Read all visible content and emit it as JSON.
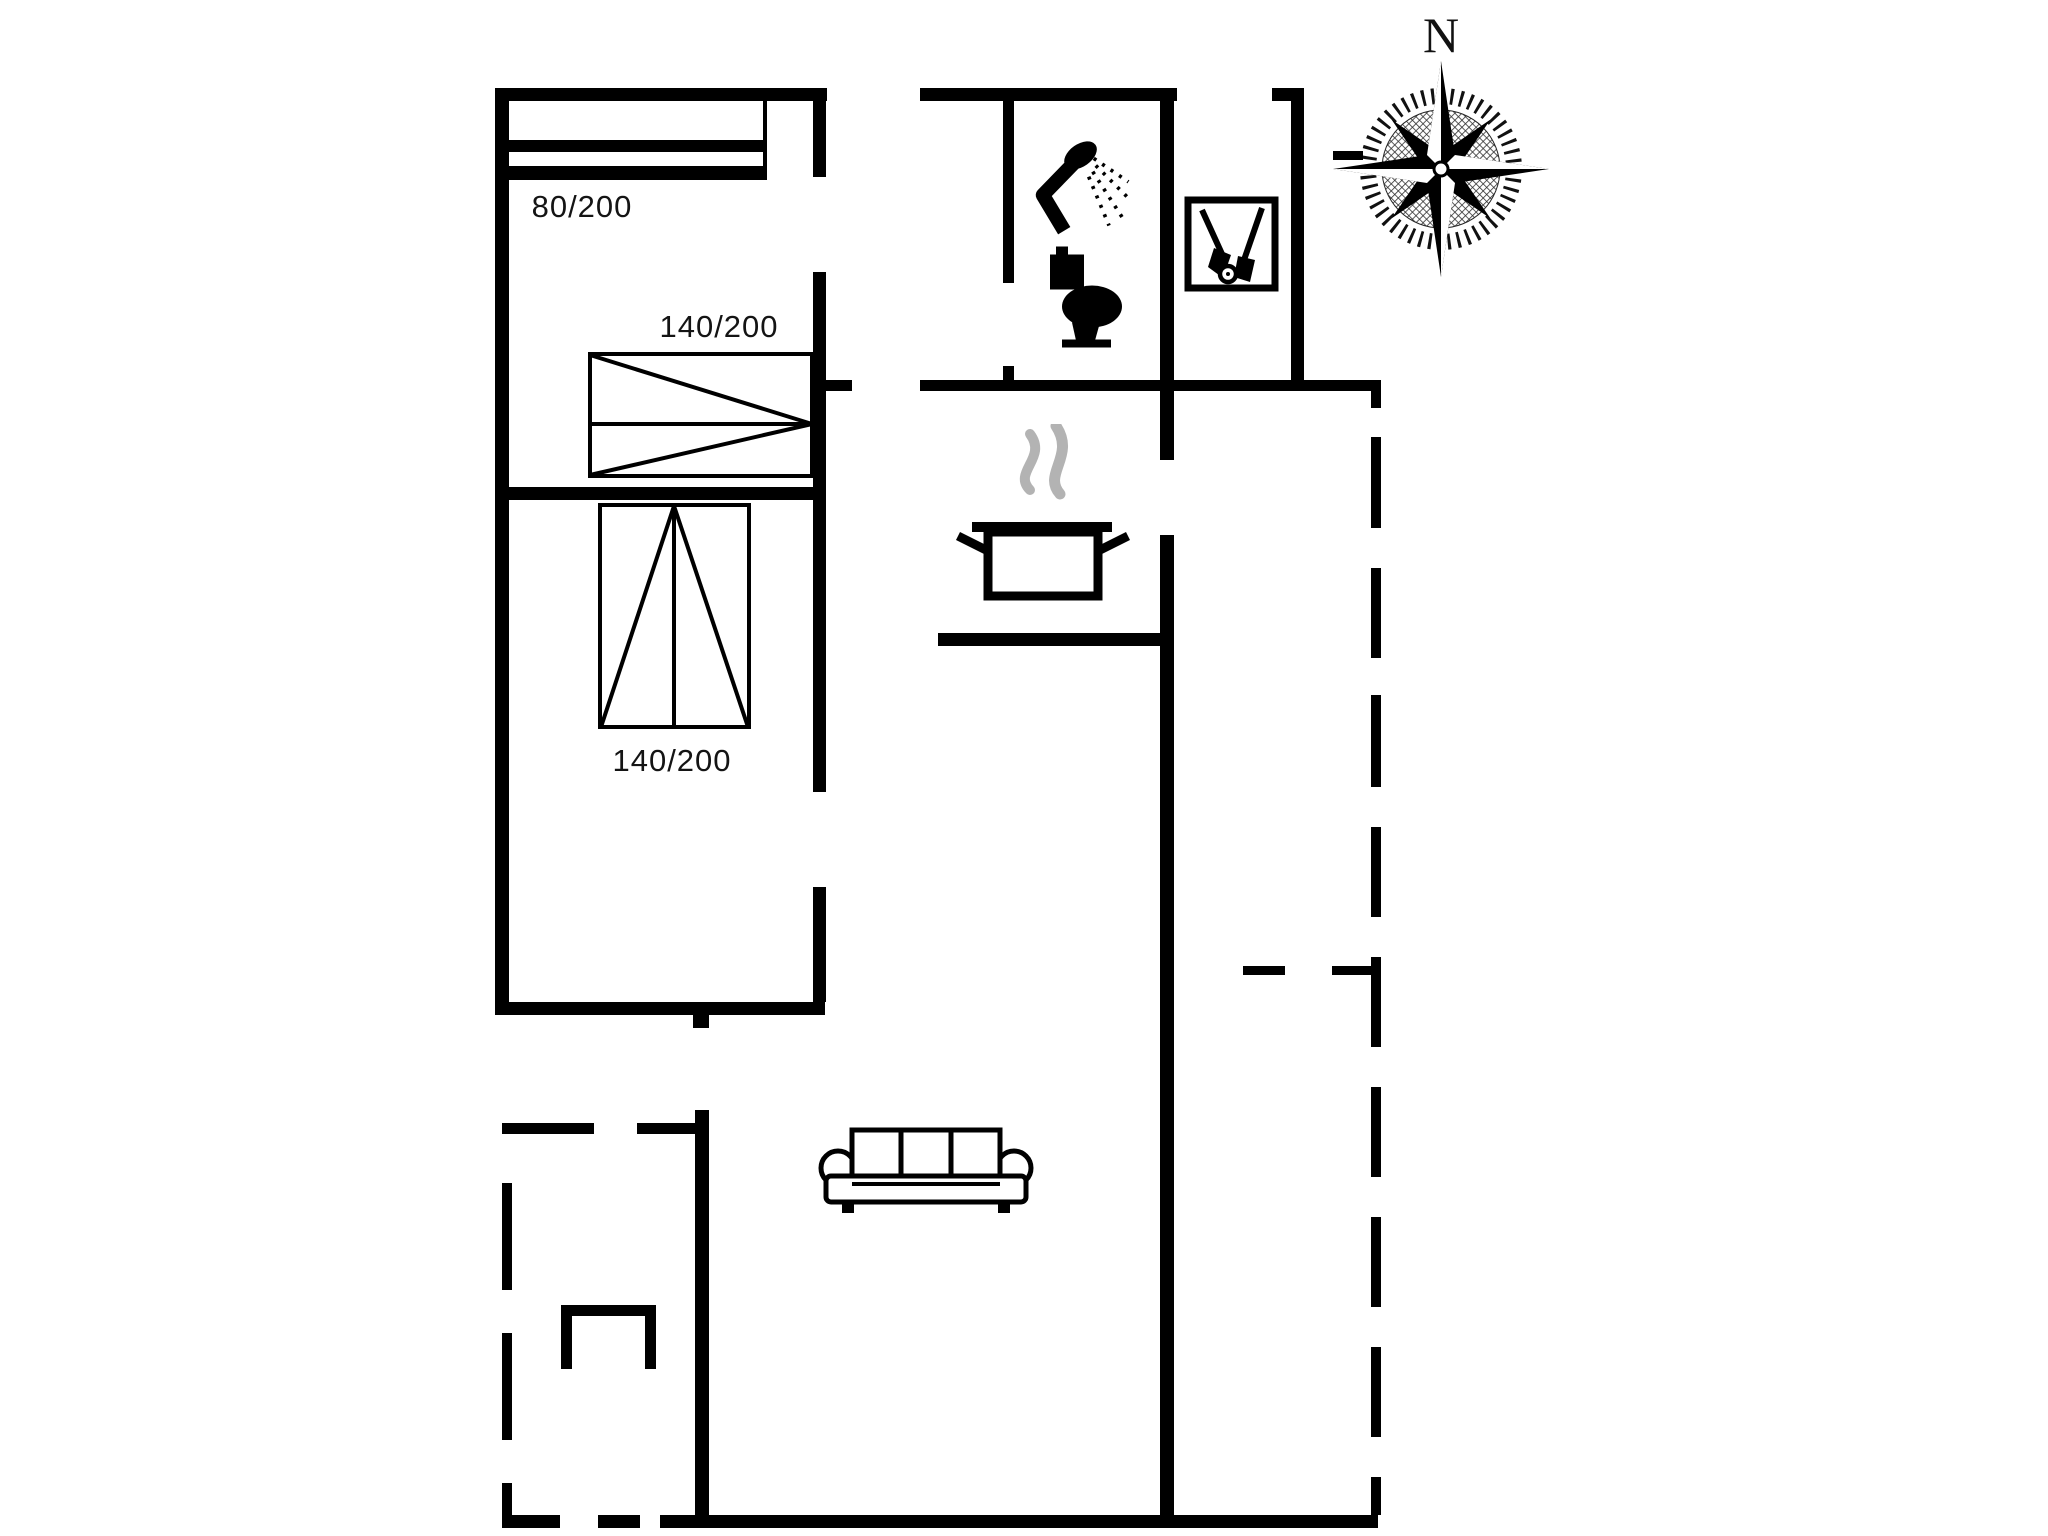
{
  "title": "Holiday home floor plan",
  "compass": {
    "north_label": "N"
  },
  "rooms": {
    "bedroom_single_bed_label": "80/200",
    "bedroom_double_bed_label": "140/200",
    "bedroom2_double_bed_label": "140/200"
  },
  "colors": {
    "wall": "#000000",
    "bg": "#ffffff",
    "steam": "#b3b3b3",
    "text": "#141414"
  },
  "icons": [
    "shower-icon",
    "toilet-icon",
    "cleaning-tools-icon",
    "cooking-pot-icon",
    "steam-icon",
    "sofa-icon",
    "grill-icon",
    "compass-rose-icon",
    "single-bed-symbol",
    "double-bed-symbol-horizontal",
    "double-bed-symbol-vertical"
  ],
  "plan": {
    "walls": [
      [
        495,
        88,
        332,
        13
      ],
      [
        495,
        88,
        14,
        927
      ],
      [
        495,
        1002,
        330,
        13
      ],
      [
        503,
        487,
        312,
        13
      ],
      [
        813,
        101,
        13,
        76
      ],
      [
        813,
        272,
        13,
        520
      ],
      [
        813,
        887,
        13,
        115
      ],
      [
        825,
        380,
        27,
        11
      ],
      [
        920,
        380,
        458,
        11
      ],
      [
        920,
        88,
        257,
        13
      ],
      [
        1003,
        101,
        11,
        182
      ],
      [
        1003,
        366,
        11,
        14
      ],
      [
        1160,
        101,
        14,
        359
      ],
      [
        1160,
        535,
        14,
        993
      ],
      [
        1272,
        88,
        32,
        13
      ],
      [
        1291,
        88,
        13,
        292
      ],
      [
        938,
        633,
        236,
        13
      ],
      [
        695,
        1110,
        14,
        418
      ],
      [
        693,
        1002,
        16,
        26
      ],
      [
        660,
        1515,
        718,
        13
      ],
      [
        1371,
        380,
        10,
        28
      ],
      [
        1333,
        151,
        30,
        9
      ],
      [
        1243,
        966,
        42,
        9
      ],
      [
        1332,
        966,
        42,
        9
      ]
    ],
    "dashes": [
      [
        502,
        1123,
        92,
        11
      ],
      [
        637,
        1123,
        60,
        11
      ],
      [
        502,
        1183,
        10,
        107
      ],
      [
        502,
        1333,
        10,
        107
      ],
      [
        502,
        1483,
        10,
        45
      ],
      [
        502,
        1515,
        58,
        13
      ],
      [
        598,
        1515,
        42,
        13
      ],
      [
        1371,
        437,
        10,
        91
      ],
      [
        1371,
        568,
        10,
        90
      ],
      [
        1371,
        695,
        10,
        92
      ],
      [
        1371,
        827,
        10,
        90
      ],
      [
        1371,
        957,
        10,
        90
      ],
      [
        1371,
        1087,
        10,
        90
      ],
      [
        1371,
        1217,
        10,
        90
      ],
      [
        1371,
        1347,
        10,
        90
      ],
      [
        1371,
        1477,
        10,
        38
      ]
    ],
    "placements": {
      "bed-single": [
        505,
        96,
        262,
        84
      ],
      "bed-double-h": [
        588,
        352,
        226,
        126
      ],
      "bed-double-v": [
        598,
        503,
        153,
        226
      ],
      "label-bed-single": [
        582,
        207
      ],
      "label-bed-double-h": [
        719,
        327
      ],
      "label-bed-double-v": [
        672,
        761
      ],
      "shower": [
        1025,
        136,
        108,
        112
      ],
      "toilet": [
        1036,
        246,
        100,
        103
      ],
      "tools": [
        1184,
        196,
        95,
        96
      ],
      "stove": [
        950,
        424,
        185,
        182
      ],
      "sofa": [
        818,
        1124,
        216,
        94
      ],
      "grill": [
        561,
        1305,
        95,
        64
      ],
      "compass": [
        1327,
        0,
        228,
        280
      ]
    }
  }
}
